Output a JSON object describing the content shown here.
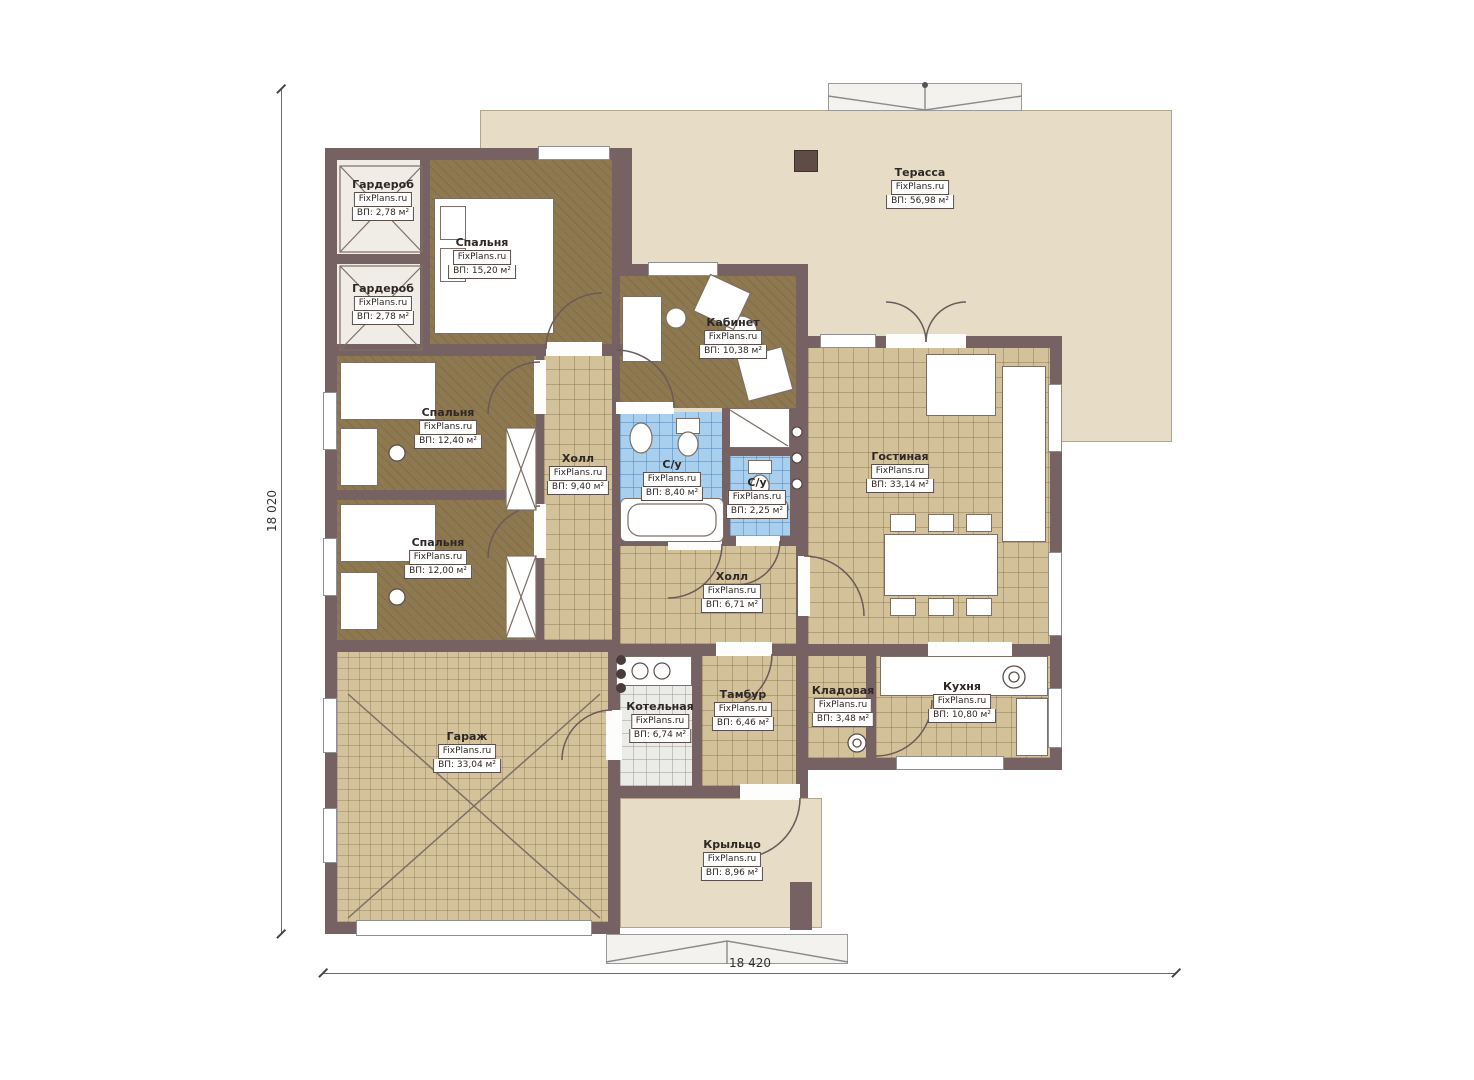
{
  "plan": {
    "brand": "FixPlans.ru",
    "dimensions": {
      "left": "18 020",
      "bottom": "18 420"
    },
    "rooms": {
      "terrace": {
        "name": "Терасса",
        "brand": "FixPlans.ru",
        "area": "ВП: 56,98 м²"
      },
      "wardrobe_top": {
        "name": "Гардероб",
        "brand": "FixPlans.ru",
        "area": "ВП: 2,78 м²"
      },
      "wardrobe_bottom": {
        "name": "Гардероб",
        "brand": "FixPlans.ru",
        "area": "ВП: 2,78 м²"
      },
      "bedroom_master": {
        "name": "Спальня",
        "brand": "FixPlans.ru",
        "area": "ВП: 15,20 м²"
      },
      "office": {
        "name": "Кабинет",
        "brand": "FixPlans.ru",
        "area": "ВП: 10,38 м²"
      },
      "bedroom_mid": {
        "name": "Спальня",
        "brand": "FixPlans.ru",
        "area": "ВП: 12,40 м²"
      },
      "bedroom_low": {
        "name": "Спальня",
        "brand": "FixPlans.ru",
        "area": "ВП: 12,00 м²"
      },
      "hall_small": {
        "name": "Холл",
        "brand": "FixPlans.ru",
        "area": "ВП: 9,40 м²"
      },
      "bath_big": {
        "name": "С/у",
        "brand": "FixPlans.ru",
        "area": "ВП: 8,40 м²"
      },
      "bath_small": {
        "name": "С/у",
        "brand": "FixPlans.ru",
        "area": "ВП: 2,25 м²"
      },
      "living": {
        "name": "Гостиная",
        "brand": "FixPlans.ru",
        "area": "ВП: 33,14 м²"
      },
      "hall_main": {
        "name": "Холл",
        "brand": "FixPlans.ru",
        "area": "ВП: 6,71 м²"
      },
      "boiler": {
        "name": "Котельная",
        "brand": "FixPlans.ru",
        "area": "ВП: 6,74 м²"
      },
      "vestibule": {
        "name": "Тамбур",
        "brand": "FixPlans.ru",
        "area": "ВП: 6,46 м²"
      },
      "storage": {
        "name": "Кладовая",
        "brand": "FixPlans.ru",
        "area": "ВП: 3,48 м²"
      },
      "kitchen": {
        "name": "Кухня",
        "brand": "FixPlans.ru",
        "area": "ВП: 10,80 м²"
      },
      "garage": {
        "name": "Гараж",
        "brand": "FixPlans.ru",
        "area": "ВП: 33,04 м²"
      },
      "porch": {
        "name": "Крыльцо",
        "brand": "FixPlans.ru",
        "area": "ВП: 8,96 м²"
      }
    },
    "colors": {
      "wall": "#776263",
      "tile": "#d3c199",
      "wood": "#8d7850",
      "bath_tile": "#a8d0ee",
      "terrace": "#e7dcc5",
      "boiler_tile": "#ebebe8"
    }
  }
}
